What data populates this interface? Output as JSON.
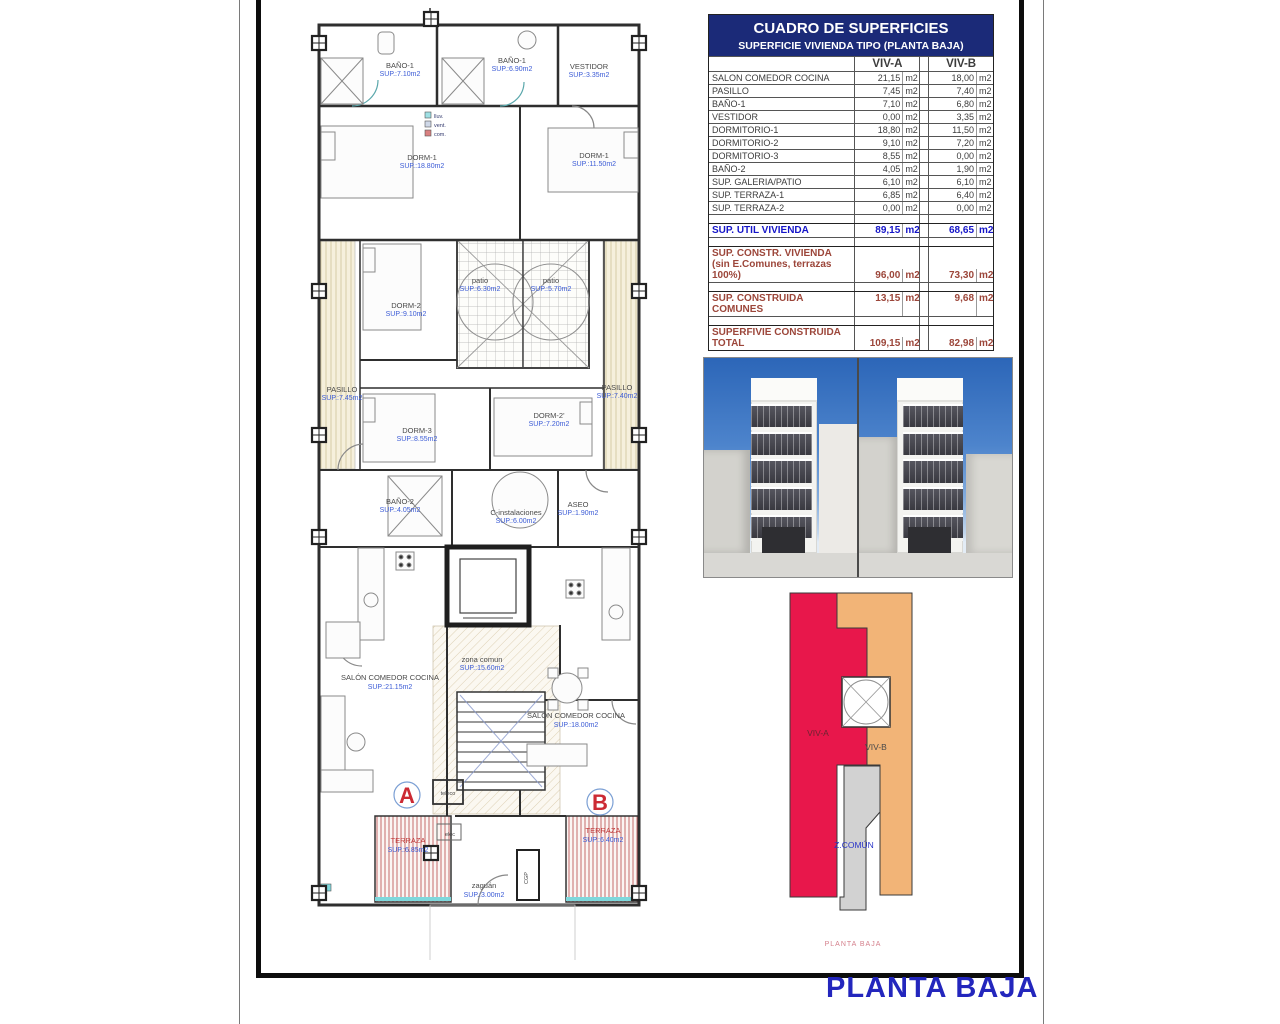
{
  "title": {
    "text": "PLANTA BAJA"
  },
  "colors": {
    "header_navy": "#1b2a78",
    "summary_blue": "#1515c8",
    "summary_maroon": "#9c463a",
    "plan_sup_blue": "#3b5bd6",
    "plan_red": "#cc2a33",
    "diagram_red": "#e8174b",
    "diagram_orange": "#f2b477",
    "diagram_gray": "#d2d2d2",
    "sky_blue": "#2c66b8",
    "title_blue": "#2326bd"
  },
  "table": {
    "title": "CUADRO DE SUPERFICIES",
    "subtitle": "SUPERFICIE VIVIENDA TIPO  (PLANTA BAJA)",
    "col_a": "VIV-A",
    "col_b": "VIV-B",
    "unit": "m2",
    "rows": [
      {
        "label": "SALON COMEDOR COCINA",
        "a": "21,15",
        "b": "18,00"
      },
      {
        "label": "PASILLO",
        "a": "7,45",
        "b": "7,40"
      },
      {
        "label": "BAÑO-1",
        "a": "7,10",
        "b": "6,80"
      },
      {
        "label": "VESTIDOR",
        "a": "0,00",
        "b": "3,35"
      },
      {
        "label": "DORMITORIO-1",
        "a": "18,80",
        "b": "11,50"
      },
      {
        "label": "DORMITORIO-2",
        "a": "9,10",
        "b": "7,20"
      },
      {
        "label": "DORMITORIO-3",
        "a": "8,55",
        "b": "0,00"
      },
      {
        "label": "BAÑO-2",
        "a": "4,05",
        "b": "1,90"
      },
      {
        "label": "SUP. GALERIA/PATIO",
        "a": "6,10",
        "b": "6,10"
      },
      {
        "label": "SUP. TERRAZA-1",
        "a": "6,85",
        "b": "6,40"
      },
      {
        "label": "SUP. TERRAZA-2",
        "a": "0,00",
        "b": "0,00"
      }
    ],
    "summary": {
      "util": {
        "label": "SUP. UTIL VIVIENDA",
        "a": "89,15",
        "b": "68,65"
      },
      "constr": {
        "label": "SUP. CONSTR. VIVIENDA",
        "label2": "(sin E.Comunes, terrazas 100%)",
        "a": "96,00",
        "b": "73,30"
      },
      "comunes": {
        "label": "SUP. CONSTRUIDA COMUNES",
        "a": "13,15",
        "b": "9,68"
      },
      "total": {
        "label": "SUPERFIVIE CONSTRUIDA",
        "label2": "TOTAL",
        "a": "109,15",
        "b": "82,98"
      }
    }
  },
  "plan": {
    "legend": [
      {
        "label": "lluv."
      },
      {
        "label": "vent."
      },
      {
        "label": "com."
      }
    ],
    "rooms": [
      {
        "name": "BAÑO-1",
        "sup": "SUP.:7.10m2"
      },
      {
        "name": "BAÑO-1",
        "sup": "SUP.:6.90m2"
      },
      {
        "name": "VESTIDOR",
        "sup": "SUP.:3.35m2"
      },
      {
        "name": "DORM-1",
        "sup": "SUP.:18.80m2"
      },
      {
        "name": "DORM-1",
        "sup": "SUP.:11.50m2"
      },
      {
        "name": "DORM-2",
        "sup": "SUP.:9.10m2"
      },
      {
        "name": "patio",
        "sup": "SUP.:6.30m2"
      },
      {
        "name": "patio",
        "sup": "SUP.:5.70m2"
      },
      {
        "name": "PASILLO",
        "sup": "SUP.:7.45m2"
      },
      {
        "name": "PASILLO",
        "sup": "SUP.:7.40m2"
      },
      {
        "name": "DORM-3",
        "sup": "SUP.:8.55m2"
      },
      {
        "name": "DORM-2'",
        "sup": "SUP.:7.20m2"
      },
      {
        "name": "BAÑO-2",
        "sup": "SUP.:4.05m2"
      },
      {
        "name": "C-instalaciones",
        "sup": "SUP.:6.00m2"
      },
      {
        "name": "ASEO",
        "sup": "SUP.:1.90m2"
      },
      {
        "name": "zona comun",
        "sup": "SUP.:15.60m2"
      },
      {
        "name": "SALÓN COMEDOR COCINA",
        "sup": "SUP.:21.15m2"
      },
      {
        "name": "SALÓN COMEDOR COCINA",
        "sup": "SUP.:18.00m2"
      },
      {
        "name": "TERRAZA",
        "sup": "SUP.:6.85m2"
      },
      {
        "name": "TERRAZA",
        "sup": "SUP.:6.40m2"
      },
      {
        "name": "zaguán",
        "sup": "SUP.:3.00m2"
      }
    ],
    "letters": {
      "a": "A",
      "b": "B"
    },
    "small": {
      "teleco": "teleco",
      "elec": "elec",
      "cgp": "CGP"
    }
  },
  "diagram": {
    "viv_a": "VIV-A",
    "viv_b": "VIV-B",
    "z_comun": "Z.COMÚN",
    "caption": "PLANTA BAJA"
  }
}
